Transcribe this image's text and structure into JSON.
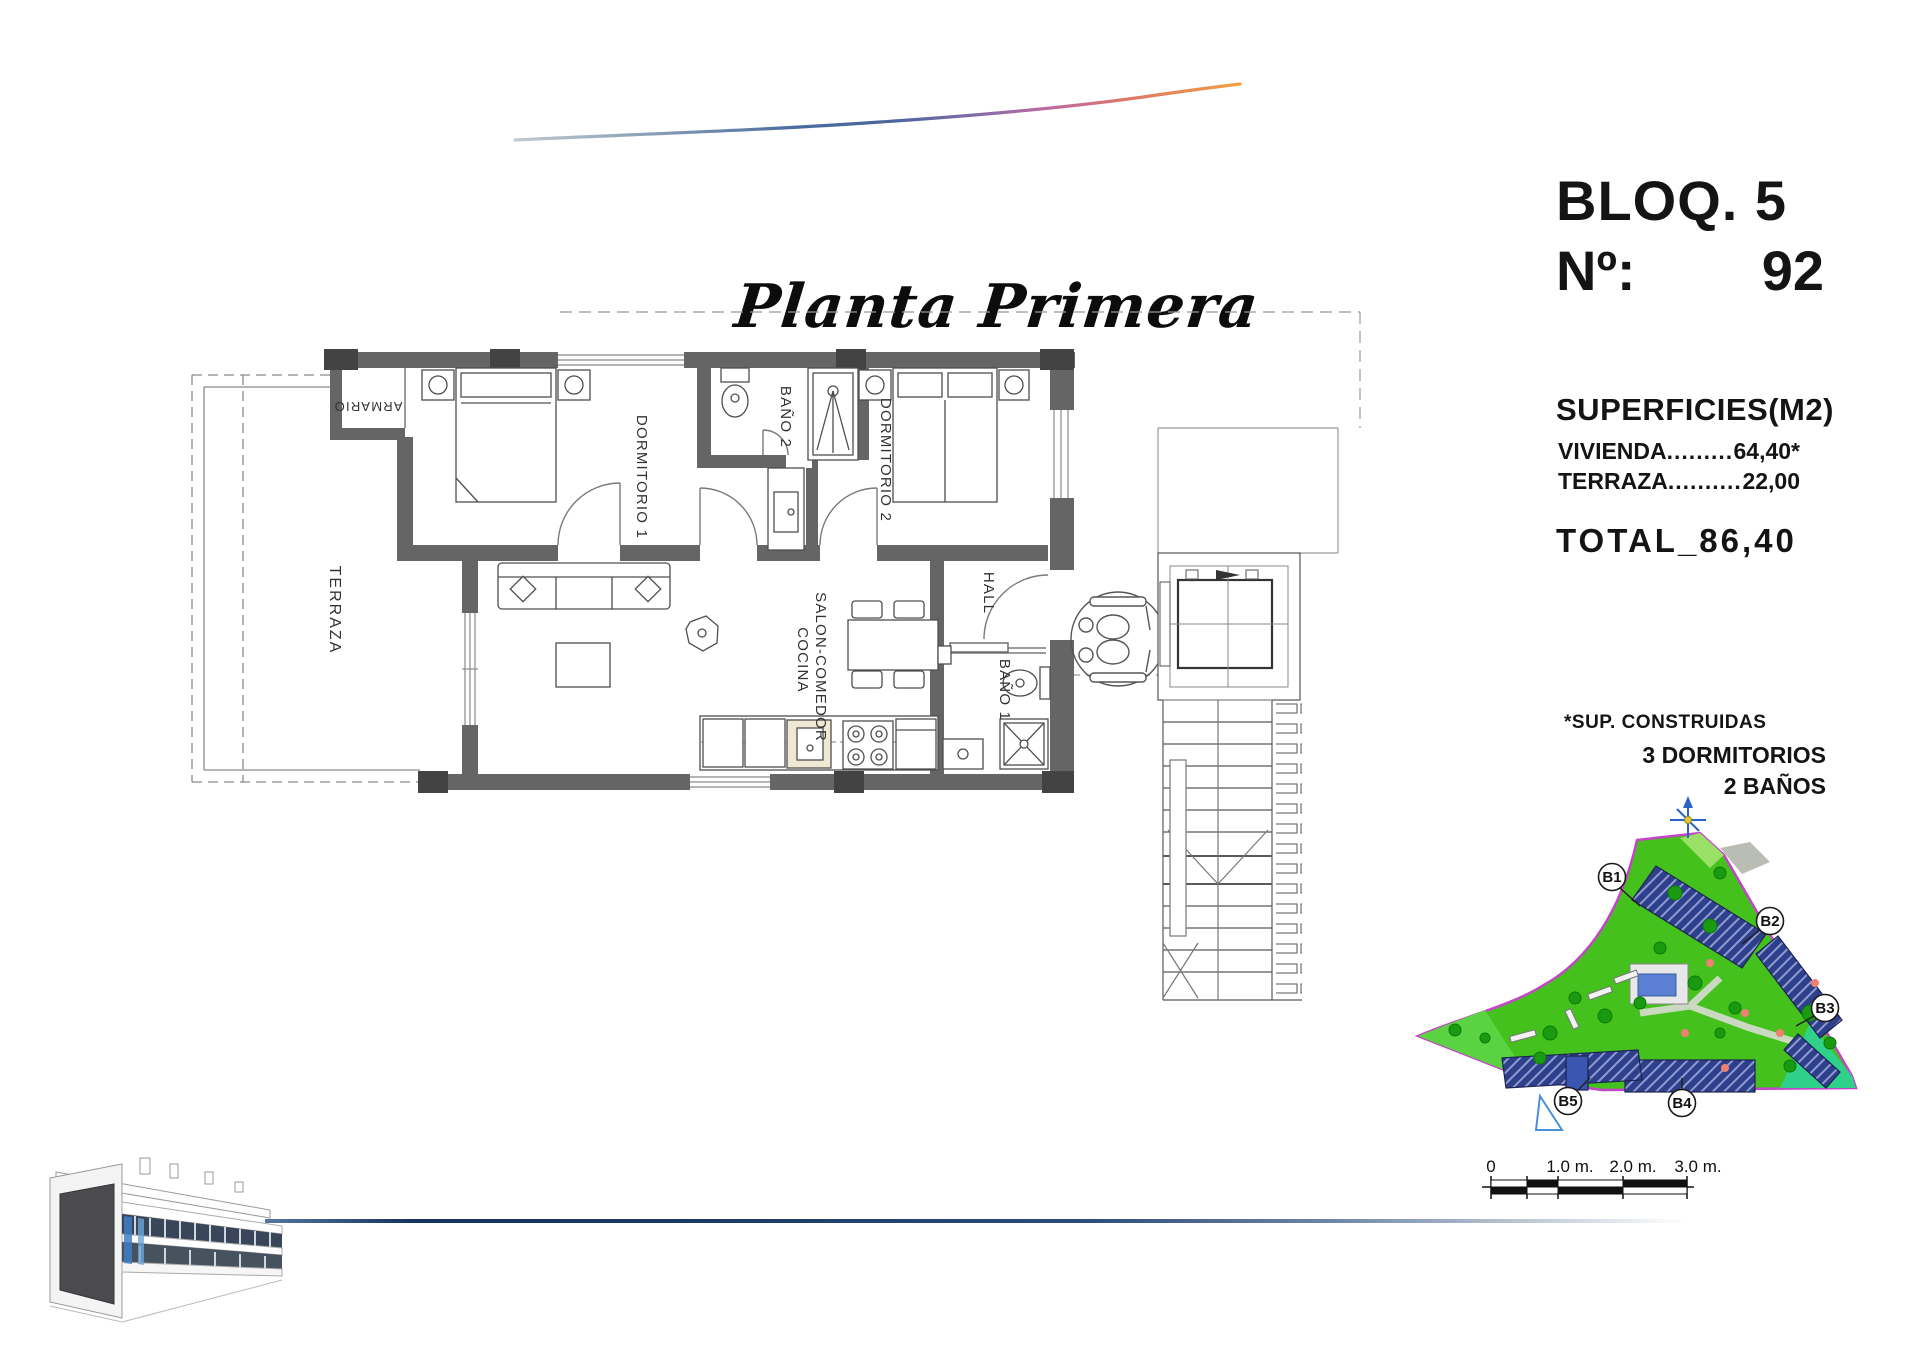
{
  "page": {
    "title_script": "Planta Primera"
  },
  "info_panel": {
    "block_label": "BLOQ. 5",
    "unit_number_label": "Nº:",
    "unit_number_value": "92",
    "surfaces_title": "SUPERFICIES(M2)",
    "surface_rows": [
      {
        "name": "VIVIENDA",
        "dots": "..................",
        "value": "64,40*"
      },
      {
        "name": "TERRAZA",
        "dots": "..............",
        "value": "22,00"
      }
    ],
    "total_label": "TOTAL",
    "total_separator": "_",
    "total_value": "86,40",
    "footnote": "*SUP. CONSTRUIDAS",
    "features": [
      {
        "label": "3 DORMITORIOS"
      },
      {
        "label": "2 BAÑOS"
      }
    ]
  },
  "floor_plan": {
    "rooms": [
      {
        "label": "ARMARIO"
      },
      {
        "label": "DORMITORIO 1"
      },
      {
        "label": "BAÑO 2"
      },
      {
        "label": "DORMITORIO 2"
      },
      {
        "label": "TERRAZA"
      },
      {
        "label": "SALON-COMEDOR"
      },
      {
        "label": "COCINA"
      },
      {
        "label": "HALL"
      },
      {
        "label": "BAÑO 1"
      }
    ]
  },
  "site_plan": {
    "blocks": [
      {
        "label": "B1"
      },
      {
        "label": "B2"
      },
      {
        "label": "B3"
      },
      {
        "label": "B4"
      },
      {
        "label": "B5"
      }
    ]
  },
  "scale_bar": {
    "labels": [
      {
        "text": "0"
      },
      {
        "text": "1.0 m."
      },
      {
        "text": "2.0 m."
      },
      {
        "text": "3.0 m."
      }
    ]
  },
  "colors": {
    "wall_gray": "#656565",
    "pier_gray": "#434343",
    "site_green": "#44c11c",
    "site_border_magenta": "#c445c8",
    "building_blue": "#2e3f8c",
    "pool_blue": "#5b7fd4",
    "line_navy": "#1d3a66",
    "swoosh_orange": "#f0a043"
  }
}
